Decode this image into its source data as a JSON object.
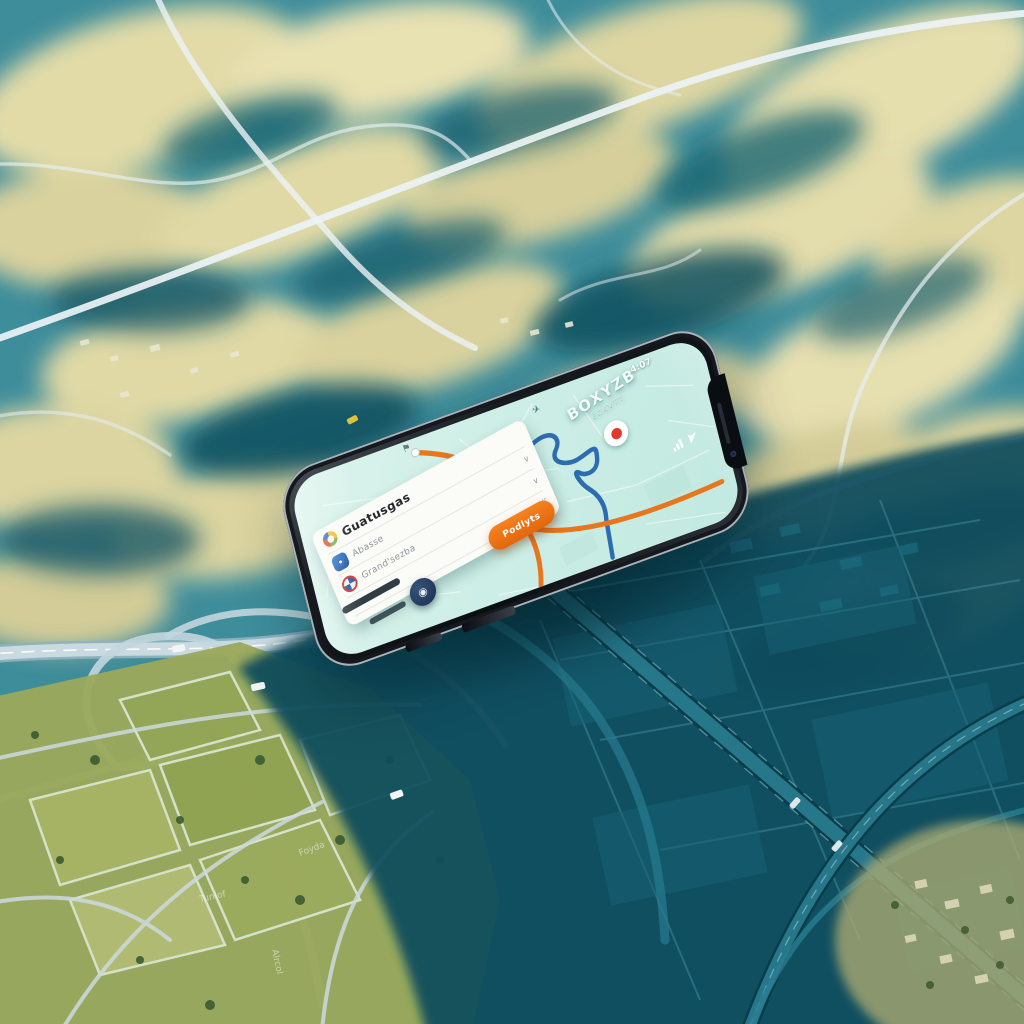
{
  "status_bar": {
    "time": "4:07"
  },
  "map_app": {
    "area_label": "BOXYZB",
    "area_sublabel": "ECKVTY",
    "navigate_button": {
      "label": "Podlyts",
      "bg": "#ef7118"
    },
    "routes": [
      {
        "name": "highlighted-route",
        "color": "#e8761e"
      },
      {
        "name": "alternate-route",
        "color": "#2e6cb0"
      }
    ],
    "marker": {
      "type": "destination-marker",
      "color": "#e03a2f"
    }
  },
  "search_card": {
    "title": "Guatusgas",
    "rows": [
      {
        "label": "Abasse"
      },
      {
        "label": "Grand'sezba"
      }
    ],
    "icons": [
      "ring-logo-icon",
      "transit-app-icon",
      "roundel-logo-icon"
    ],
    "chevron": "∨"
  },
  "glyphs": {
    "plane": "✈",
    "flag": "⚑",
    "fab": "◉"
  },
  "background": {
    "road_labels": [
      "Tunlof",
      "Foyda",
      "Alrcol"
    ],
    "palette": {
      "terrain_teal": "#3e8d9b",
      "hill_tan": "#e3dcab",
      "hill_shadow_teal": "#1c6372",
      "field_green": "#9aa95c",
      "cast_shadow": "#0e4c5b",
      "road": "#ecf3f5",
      "map_screen": "#cdeee6"
    }
  }
}
